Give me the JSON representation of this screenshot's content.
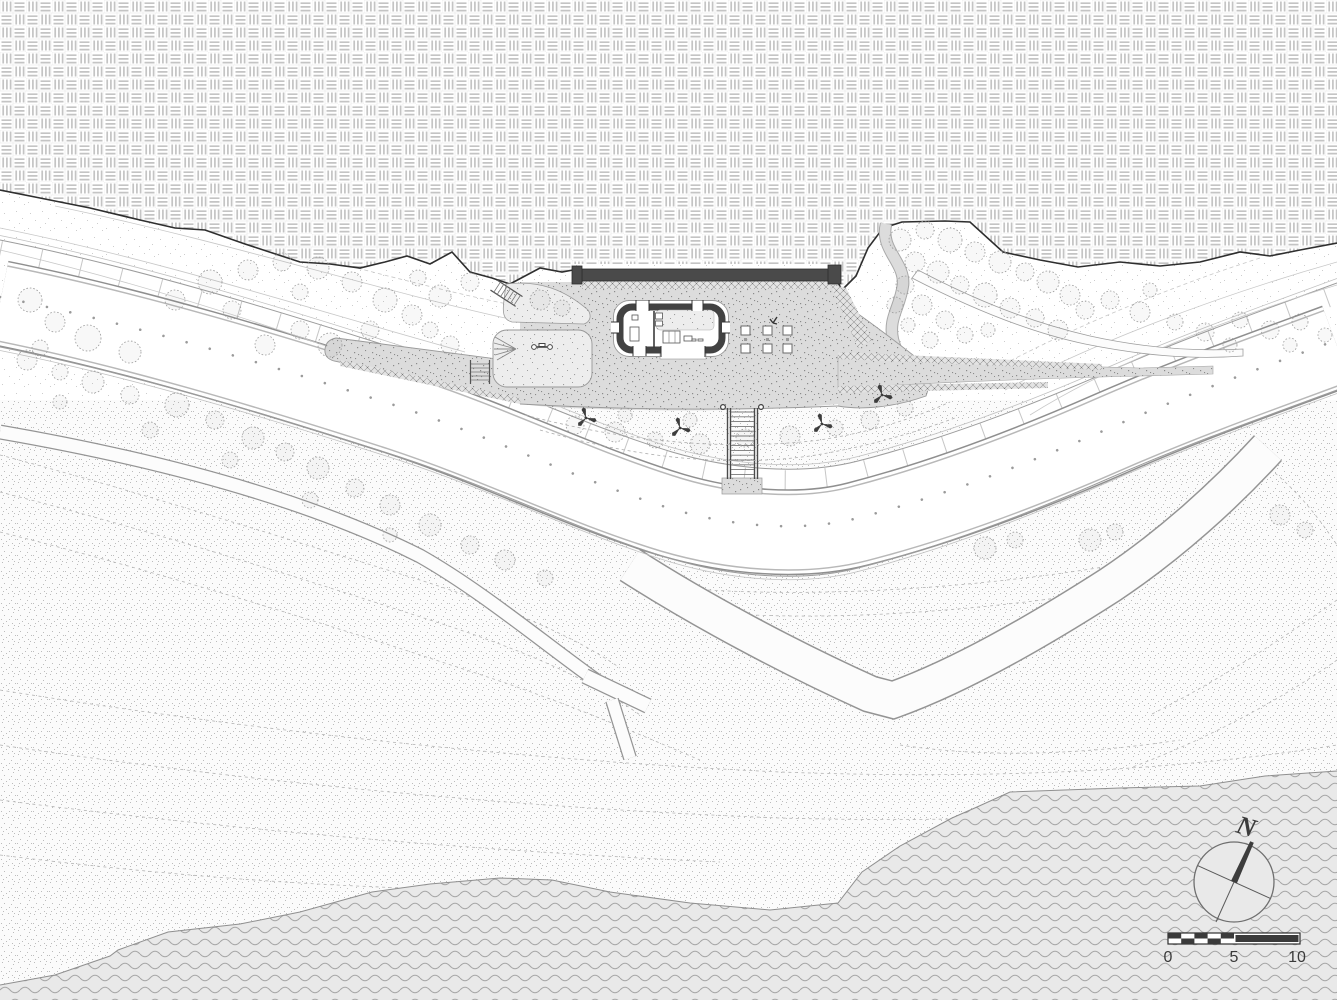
{
  "compass": {
    "north_label": "N",
    "icon": "north-arrow-icon"
  },
  "scale_bar": {
    "labels": [
      "0",
      "5",
      "10"
    ],
    "icon": "scale-bar-icon"
  },
  "colors": {
    "paper": "#ffffff",
    "boundary_line": "#2e2e2e",
    "water_fill": "#e9e9e9",
    "wave_line": "#a6a6a6",
    "plaza_fill": "#dcdcdc",
    "wall_dark": "#4a4a4a",
    "building_wall": "#424242",
    "road_edge": "#8f8f8f",
    "contour_line": "#c6c6c6",
    "tree_line": "#9b9b9b",
    "needle_dark": "#3d3d3d",
    "label_text": "#3b3b3b"
  }
}
